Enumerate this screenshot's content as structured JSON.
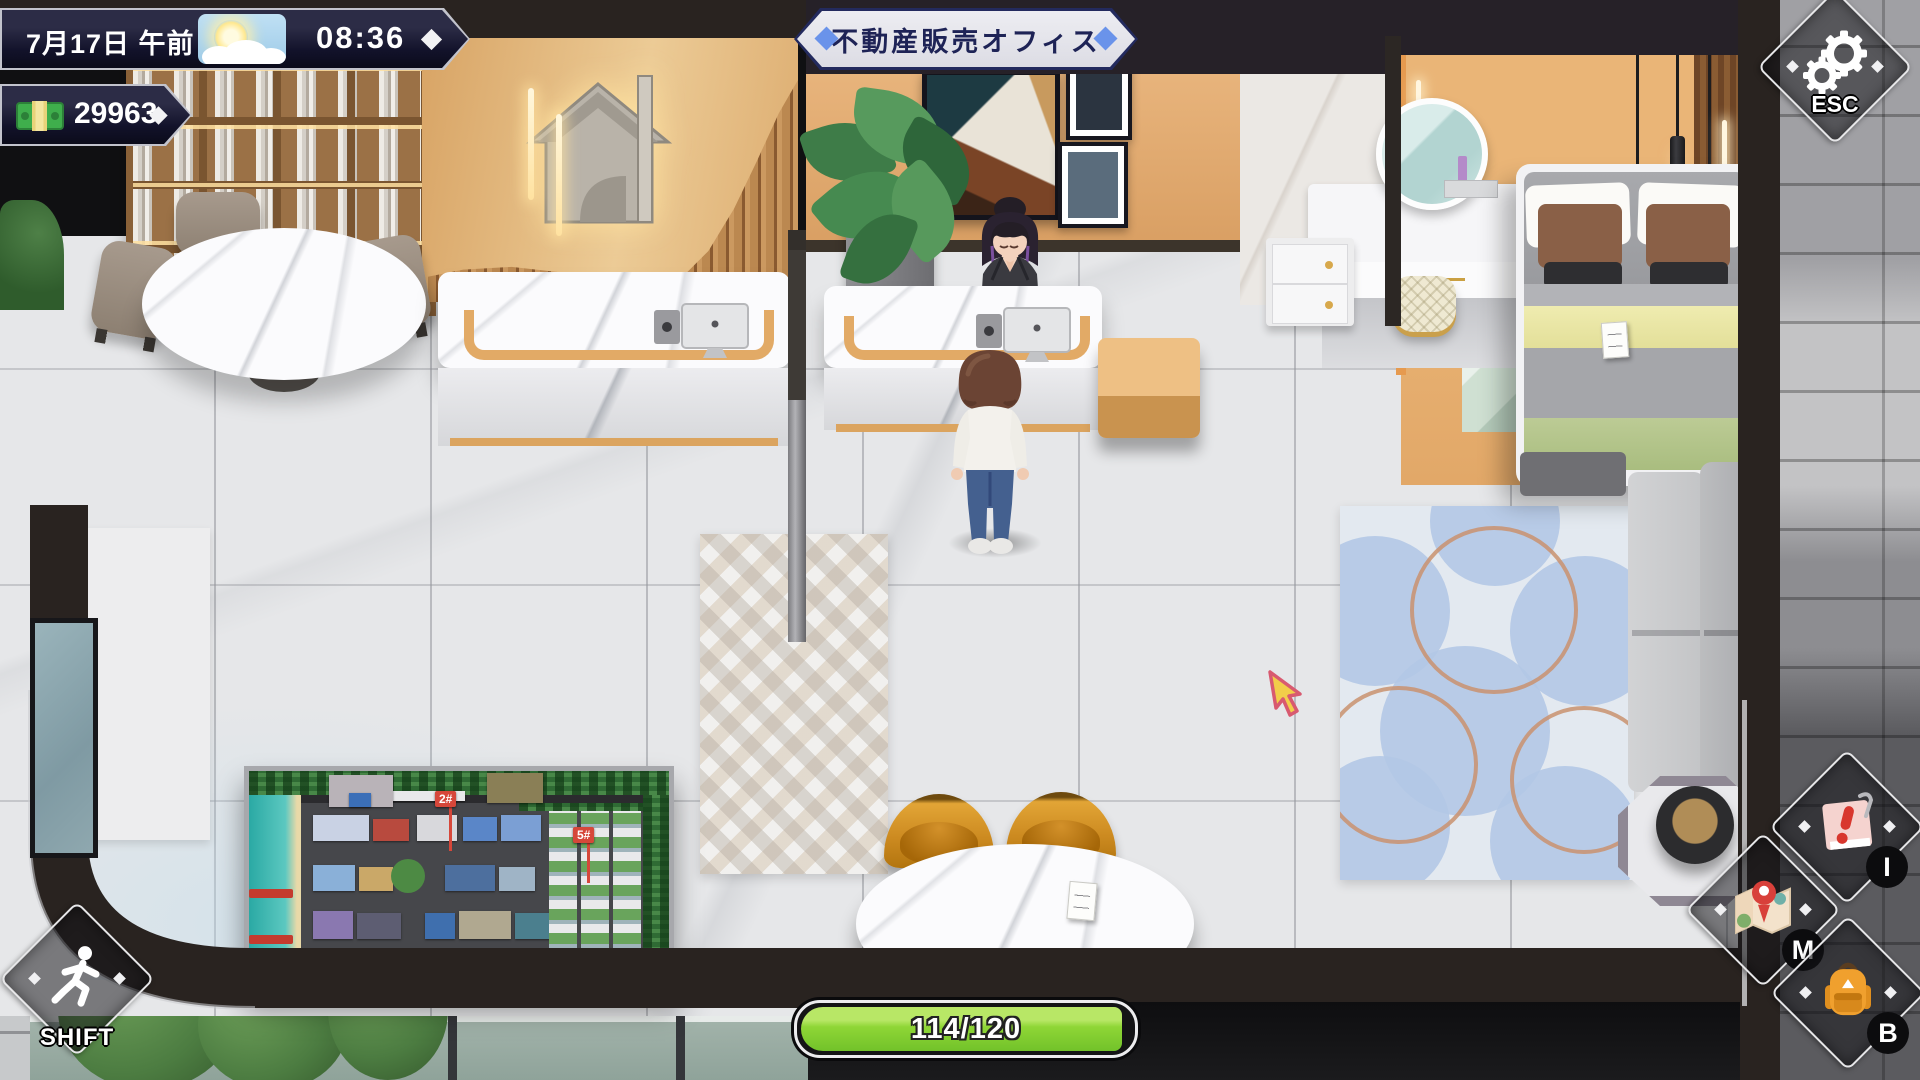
{
  "hud": {
    "datetime_bar": {
      "date": "7月17日 午前",
      "time": "08:36",
      "weather": "sunny-with-clouds"
    },
    "money_bar": {
      "amount": "29963"
    },
    "location_banner": {
      "title": "不動産販売オフィス"
    },
    "esc_button": {
      "label": "ESC"
    },
    "shift_button": {
      "label": "SHIFT"
    },
    "quick_buttons": [
      {
        "key": "I",
        "icon": "notepad-exclamation-icon"
      },
      {
        "key": "M",
        "icon": "map-pin-icon"
      },
      {
        "key": "B",
        "icon": "backpack-icon"
      }
    ],
    "stamina_bar": {
      "label": "114/120",
      "value": 114,
      "max": 120
    }
  },
  "scene": {
    "city_model": {
      "markers": [
        "2#",
        "5#"
      ]
    }
  },
  "colors": {
    "hud_navy": "#14142a",
    "banner_fill": "#e6e6ee",
    "banner_border": "#232a5e",
    "diamond_blue": "#6a93ea",
    "stamina_green": "#86d438",
    "cursor_yellow": "#f2cd4a"
  }
}
